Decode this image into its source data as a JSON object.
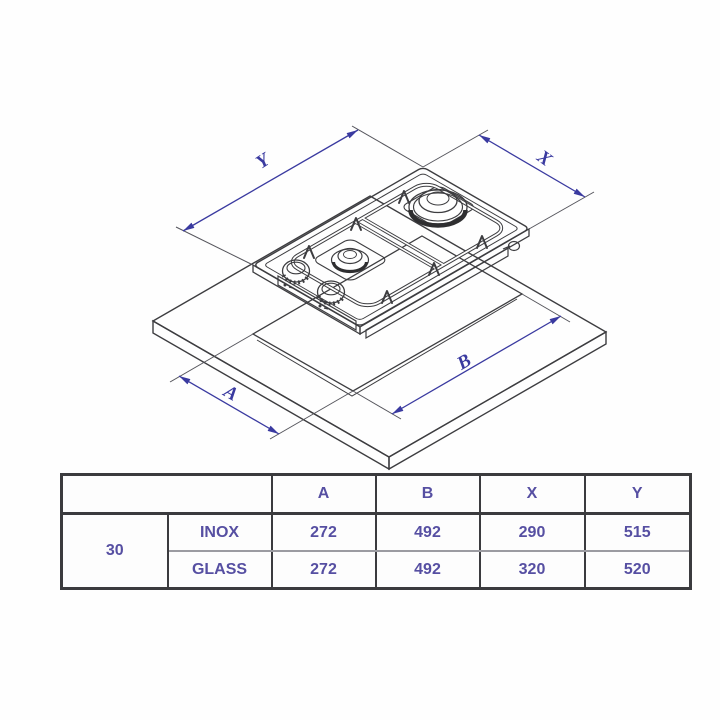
{
  "diagram": {
    "dimension_labels": {
      "y": "Y",
      "x": "X",
      "a": "A",
      "b": "B"
    },
    "colors": {
      "dimension_blue": "#3a3aa0",
      "line_dark": "#3d3d40",
      "table_text_purple": "#564fa2",
      "table_border": "#3b3b3e"
    }
  },
  "table": {
    "headers": [
      "A",
      "B",
      "X",
      "Y"
    ],
    "size_label": "30",
    "rows": [
      {
        "finish": "INOX",
        "values": [
          "272",
          "492",
          "290",
          "515"
        ]
      },
      {
        "finish": "GLASS",
        "values": [
          "272",
          "492",
          "320",
          "520"
        ]
      }
    ]
  }
}
